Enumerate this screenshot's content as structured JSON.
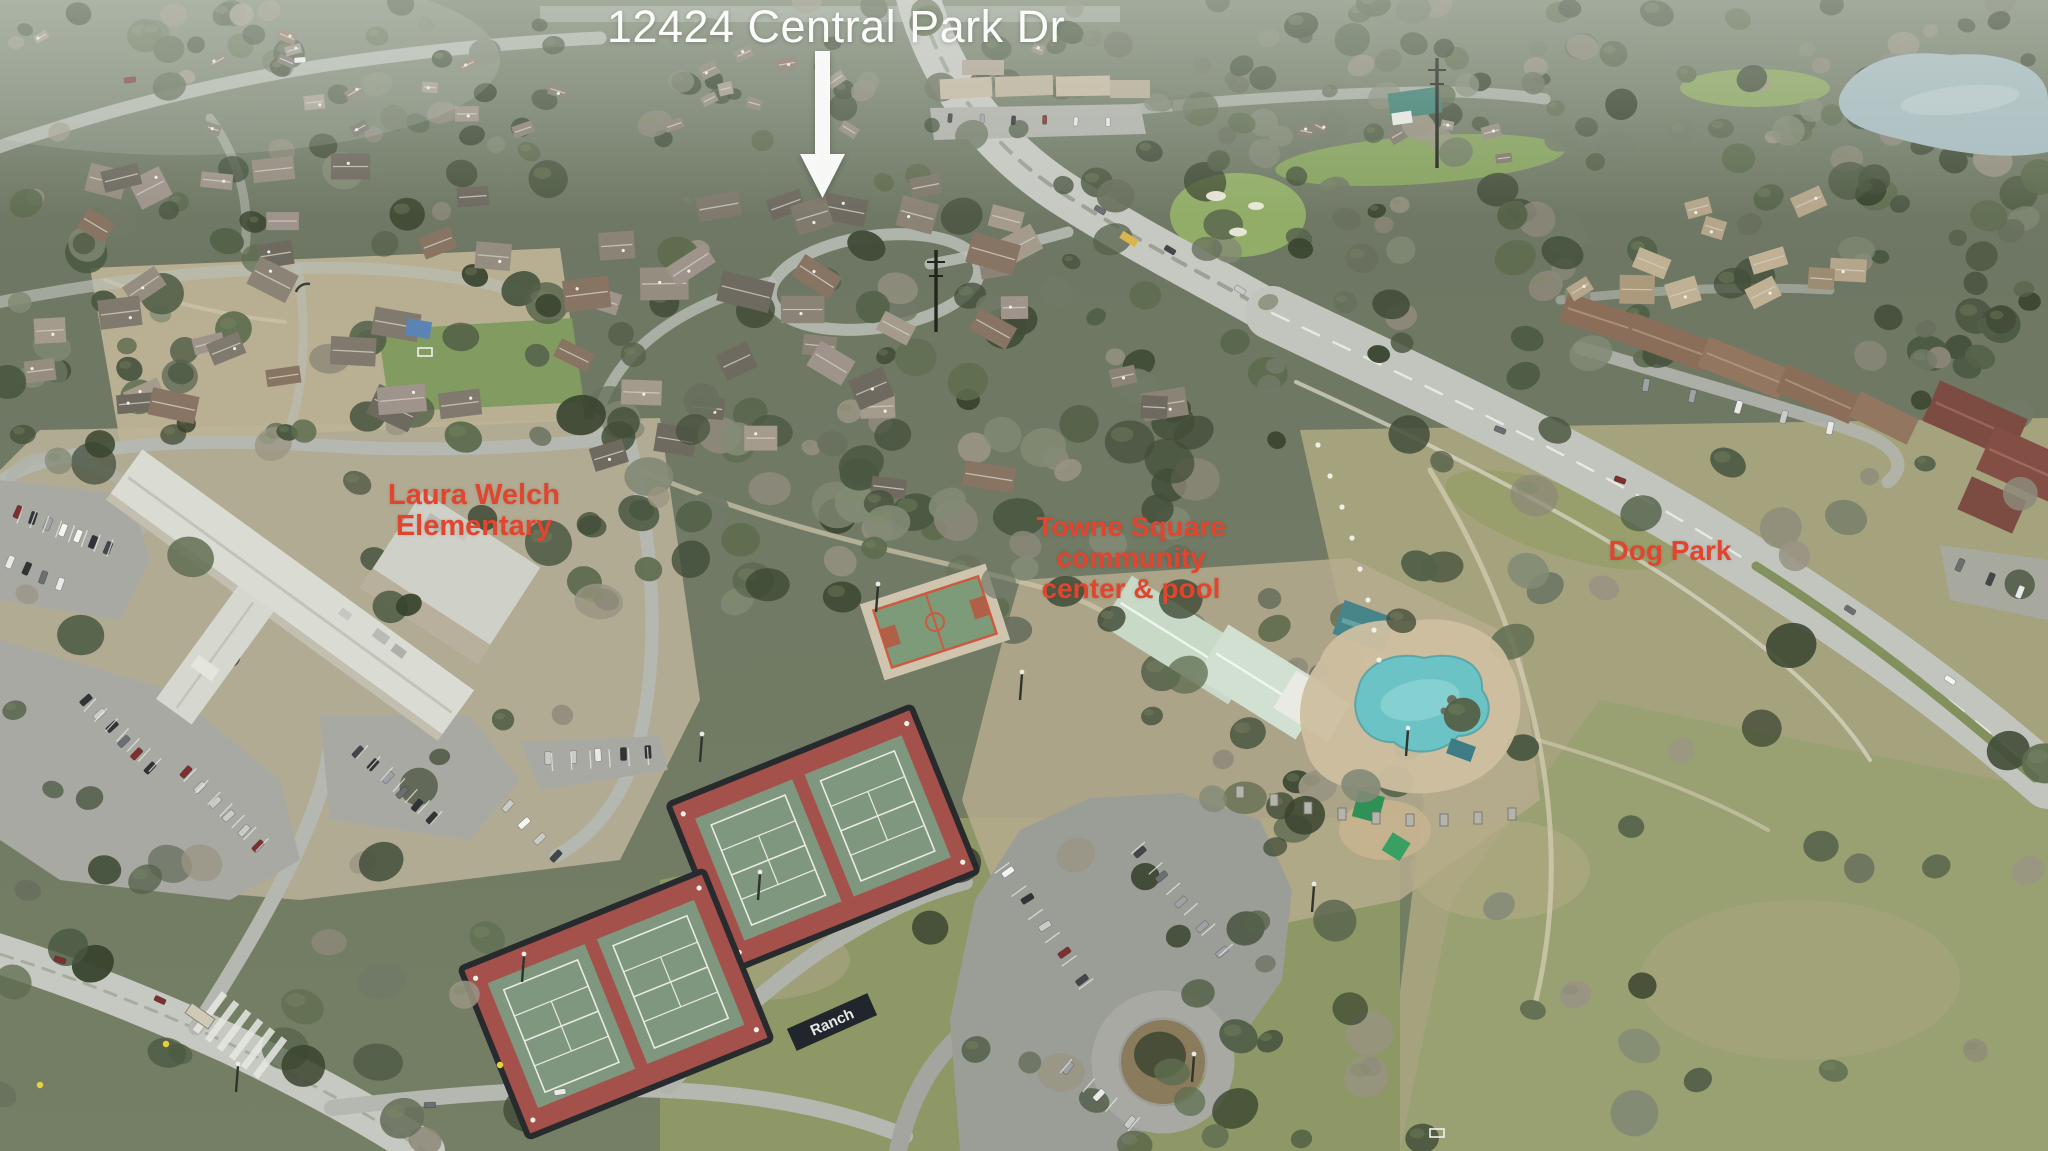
{
  "photo": {
    "description": "Aerial drone photograph of a suburban neighborhood in winter, with an elementary school, community center with pool, tennis courts, dog park, golf course, pond and residential streets",
    "colors": {
      "label_red": "#e2452e",
      "title_white": "#fbfcfa",
      "arrow_white": "#fdfdfc",
      "pool_aqua": "#6cc3c6",
      "court_red": "#a3514a",
      "court_green": "#7f977e",
      "water": "#a7bcc0"
    }
  },
  "annotations": {
    "title": "12424 Central Park Dr",
    "arrow": "down-arrow",
    "school_label": {
      "line1": "Laura Welch",
      "line2": "Elementary"
    },
    "community_label": {
      "line1": "Towne Square",
      "line2": "community",
      "line3": "center & pool"
    },
    "dog_park_label": "Dog Park",
    "tennis_banner": "Ranch"
  }
}
